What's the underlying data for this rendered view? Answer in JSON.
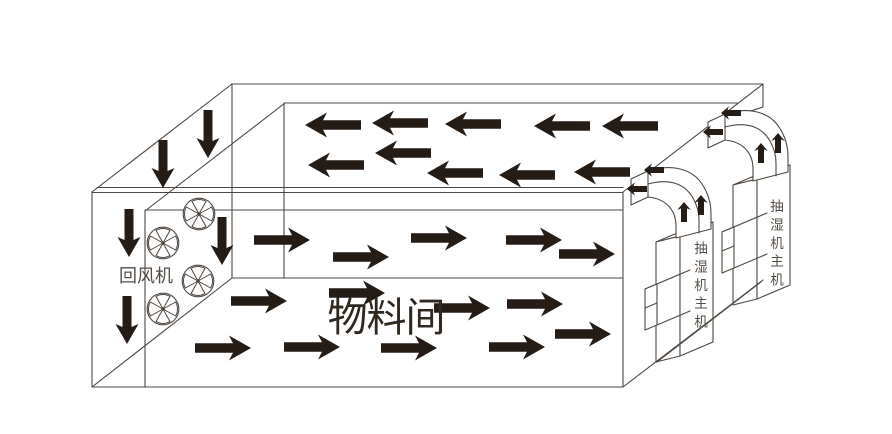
{
  "diagram": {
    "type": "drying-room-airflow-schematic",
    "background": "#ffffff",
    "colors": {
      "line": "#4f4741",
      "arrow": "#251c16",
      "label_gray": "#554e47",
      "label_dark": "#30281f"
    },
    "labels": {
      "return_fan": {
        "text": "回风机",
        "x": 146,
        "y": 282,
        "size": 18
      },
      "material_room": {
        "text": "物料间",
        "x": 386,
        "y": 331,
        "size": 40
      },
      "dehumidifier_unit_1": {
        "text": "抽湿机主机",
        "x": 701,
        "y": 253,
        "size": 13.5,
        "step": 18.4
      },
      "dehumidifier_unit_2": {
        "text": "抽湿机主机",
        "x": 777,
        "y": 211,
        "size": 13.5,
        "step": 18.4
      }
    },
    "fans": {
      "radius": 15.8,
      "positions": [
        {
          "cx": 199,
          "cy": 214
        },
        {
          "cx": 163,
          "cy": 243
        },
        {
          "cx": 198,
          "cy": 281
        },
        {
          "cx": 163,
          "cy": 309
        }
      ]
    },
    "airflow": {
      "ceiling": {
        "direction": "left",
        "points": [
          [
            333,
            125
          ],
          [
            400,
            123
          ],
          [
            473,
            124
          ],
          [
            562,
            126
          ],
          [
            630,
            126
          ],
          [
            336,
            165
          ],
          [
            403,
            153
          ],
          [
            455,
            173
          ],
          [
            527,
            175
          ],
          [
            602,
            172
          ]
        ]
      },
      "mid_level": {
        "direction": "right",
        "points": [
          [
            282,
            240
          ],
          [
            361,
            257
          ],
          [
            439,
            238
          ],
          [
            534,
            240
          ],
          [
            587,
            254
          ]
        ]
      },
      "floor_level": {
        "direction": "right",
        "points": [
          [
            259,
            301
          ],
          [
            357,
            293
          ],
          [
            462,
            308
          ],
          [
            535,
            304
          ],
          [
            583,
            334
          ],
          [
            223,
            348
          ],
          [
            312,
            347
          ],
          [
            409,
            348
          ],
          [
            517,
            347
          ]
        ]
      },
      "left_wall": {
        "direction": "down",
        "points": [
          [
            163,
            164
          ],
          [
            208,
            134
          ],
          [
            129,
            233
          ],
          [
            127,
            320
          ],
          [
            222,
            241
          ]
        ]
      },
      "duct_1": [
        {
          "x": 654,
          "y": 170,
          "dir": "left"
        },
        {
          "x": 637,
          "y": 189,
          "dir": "left"
        },
        {
          "x": 684,
          "y": 212,
          "dir": "up"
        },
        {
          "x": 701,
          "y": 205,
          "dir": "up"
        }
      ],
      "duct_2": [
        {
          "x": 731,
          "y": 113,
          "dir": "left"
        },
        {
          "x": 713,
          "y": 132,
          "dir": "left"
        },
        {
          "x": 761,
          "y": 153,
          "dir": "up"
        },
        {
          "x": 778,
          "y": 143,
          "dir": "up"
        }
      ]
    }
  }
}
